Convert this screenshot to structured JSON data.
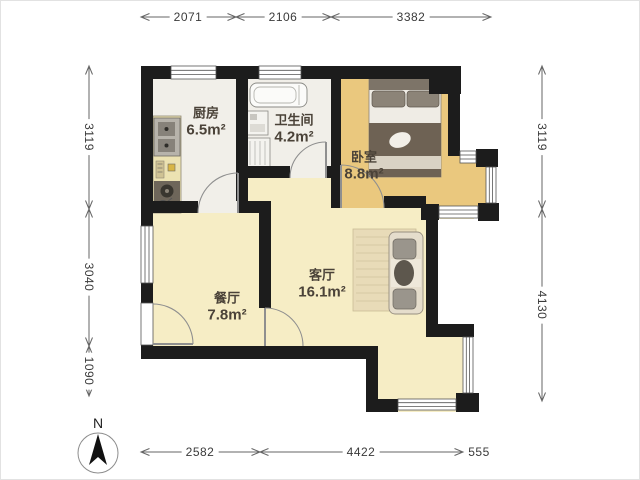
{
  "plan": {
    "rooms": [
      {
        "id": "kitchen",
        "name": "厨房",
        "area": "6.5m²"
      },
      {
        "id": "bathroom",
        "name": "卫生间",
        "area": "4.2m²"
      },
      {
        "id": "bedroom",
        "name": "卧室",
        "area": "8.8m²"
      },
      {
        "id": "dining",
        "name": "餐厅",
        "area": "7.8m²"
      },
      {
        "id": "living",
        "name": "客厅",
        "area": "16.1m²"
      }
    ],
    "dimensions": {
      "top": [
        "2071",
        "2106",
        "3382"
      ],
      "left": [
        "3119",
        "3040",
        "1090"
      ],
      "right": [
        "3119",
        "4130"
      ],
      "bottom": [
        "2582",
        "4422",
        "555"
      ]
    },
    "compass": {
      "label": "N"
    },
    "colors": {
      "wall": "#1c1c1c",
      "wood_floor": "#eac87e",
      "tile_floor": "#f1efe9",
      "marble_floor": "#f6edc5",
      "counter": "#ece2b2",
      "dim_text": "#3a3a3a",
      "label_text": "#4a4238"
    }
  }
}
